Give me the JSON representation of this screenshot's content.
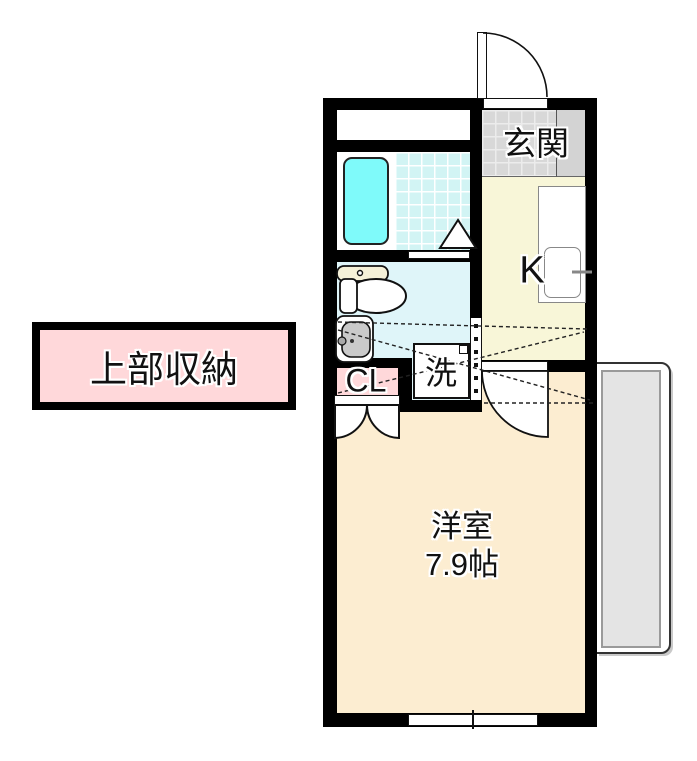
{
  "floor_plan": {
    "rooms": {
      "entrance": {
        "label": "玄関"
      },
      "kitchen": {
        "label": "K"
      },
      "laundry_space": {
        "label": "洗"
      },
      "closet": {
        "label": "CL"
      },
      "western_room": {
        "name": "洋室",
        "size": "7.9帖"
      }
    },
    "callout": {
      "upper_storage": "上部収納"
    },
    "colors": {
      "wall": "#000000",
      "western_room_floor": "#FCEDD1",
      "kitchen_floor": "#F8F6D8",
      "entrance_tile": "#D8D8D8",
      "washroom_floor": "#DFF5F9",
      "bathroom_tile": "#D2F4F4",
      "bathtub": "#7FFAFA",
      "closet_pink": "#FFD8DA",
      "balcony_gray": "#E4E4E4",
      "toilet_cream": "#F5F1D8"
    }
  }
}
